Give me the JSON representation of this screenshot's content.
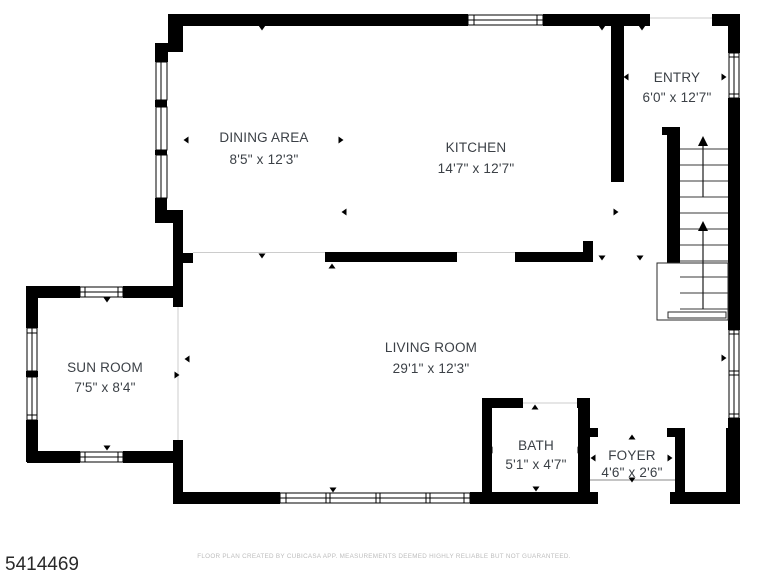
{
  "plan": {
    "listing_id": "5414469",
    "disclaimer": "FLOOR PLAN CREATED BY CUBICASA APP. MEASUREMENTS DEEMED HIGHLY RELIABLE BUT NOT GUARANTEED.",
    "colors": {
      "wall": "#000000",
      "label_text": "#3b4046",
      "disclaimer_text": "#bdbdbd",
      "background": "#ffffff"
    },
    "rooms": [
      {
        "key": "dining-area",
        "name": "DINING AREA",
        "dims": "8'5\" x 12'3\""
      },
      {
        "key": "kitchen",
        "name": "KITCHEN",
        "dims": "14'7\" x 12'7\""
      },
      {
        "key": "entry",
        "name": "ENTRY",
        "dims": "6'0\" x 12'7\""
      },
      {
        "key": "sun-room",
        "name": "SUN ROOM",
        "dims": "7'5\" x 8'4\""
      },
      {
        "key": "living-room",
        "name": "LIVING ROOM",
        "dims": "29'1\" x 12'3\""
      },
      {
        "key": "bath",
        "name": "BATH",
        "dims": "5'1\" x 4'7\""
      },
      {
        "key": "foyer",
        "name": "FOYER",
        "dims": "4'6\" x 2'6\""
      }
    ],
    "features": [
      "staircase-up",
      "windows",
      "door-opening-markers"
    ]
  }
}
